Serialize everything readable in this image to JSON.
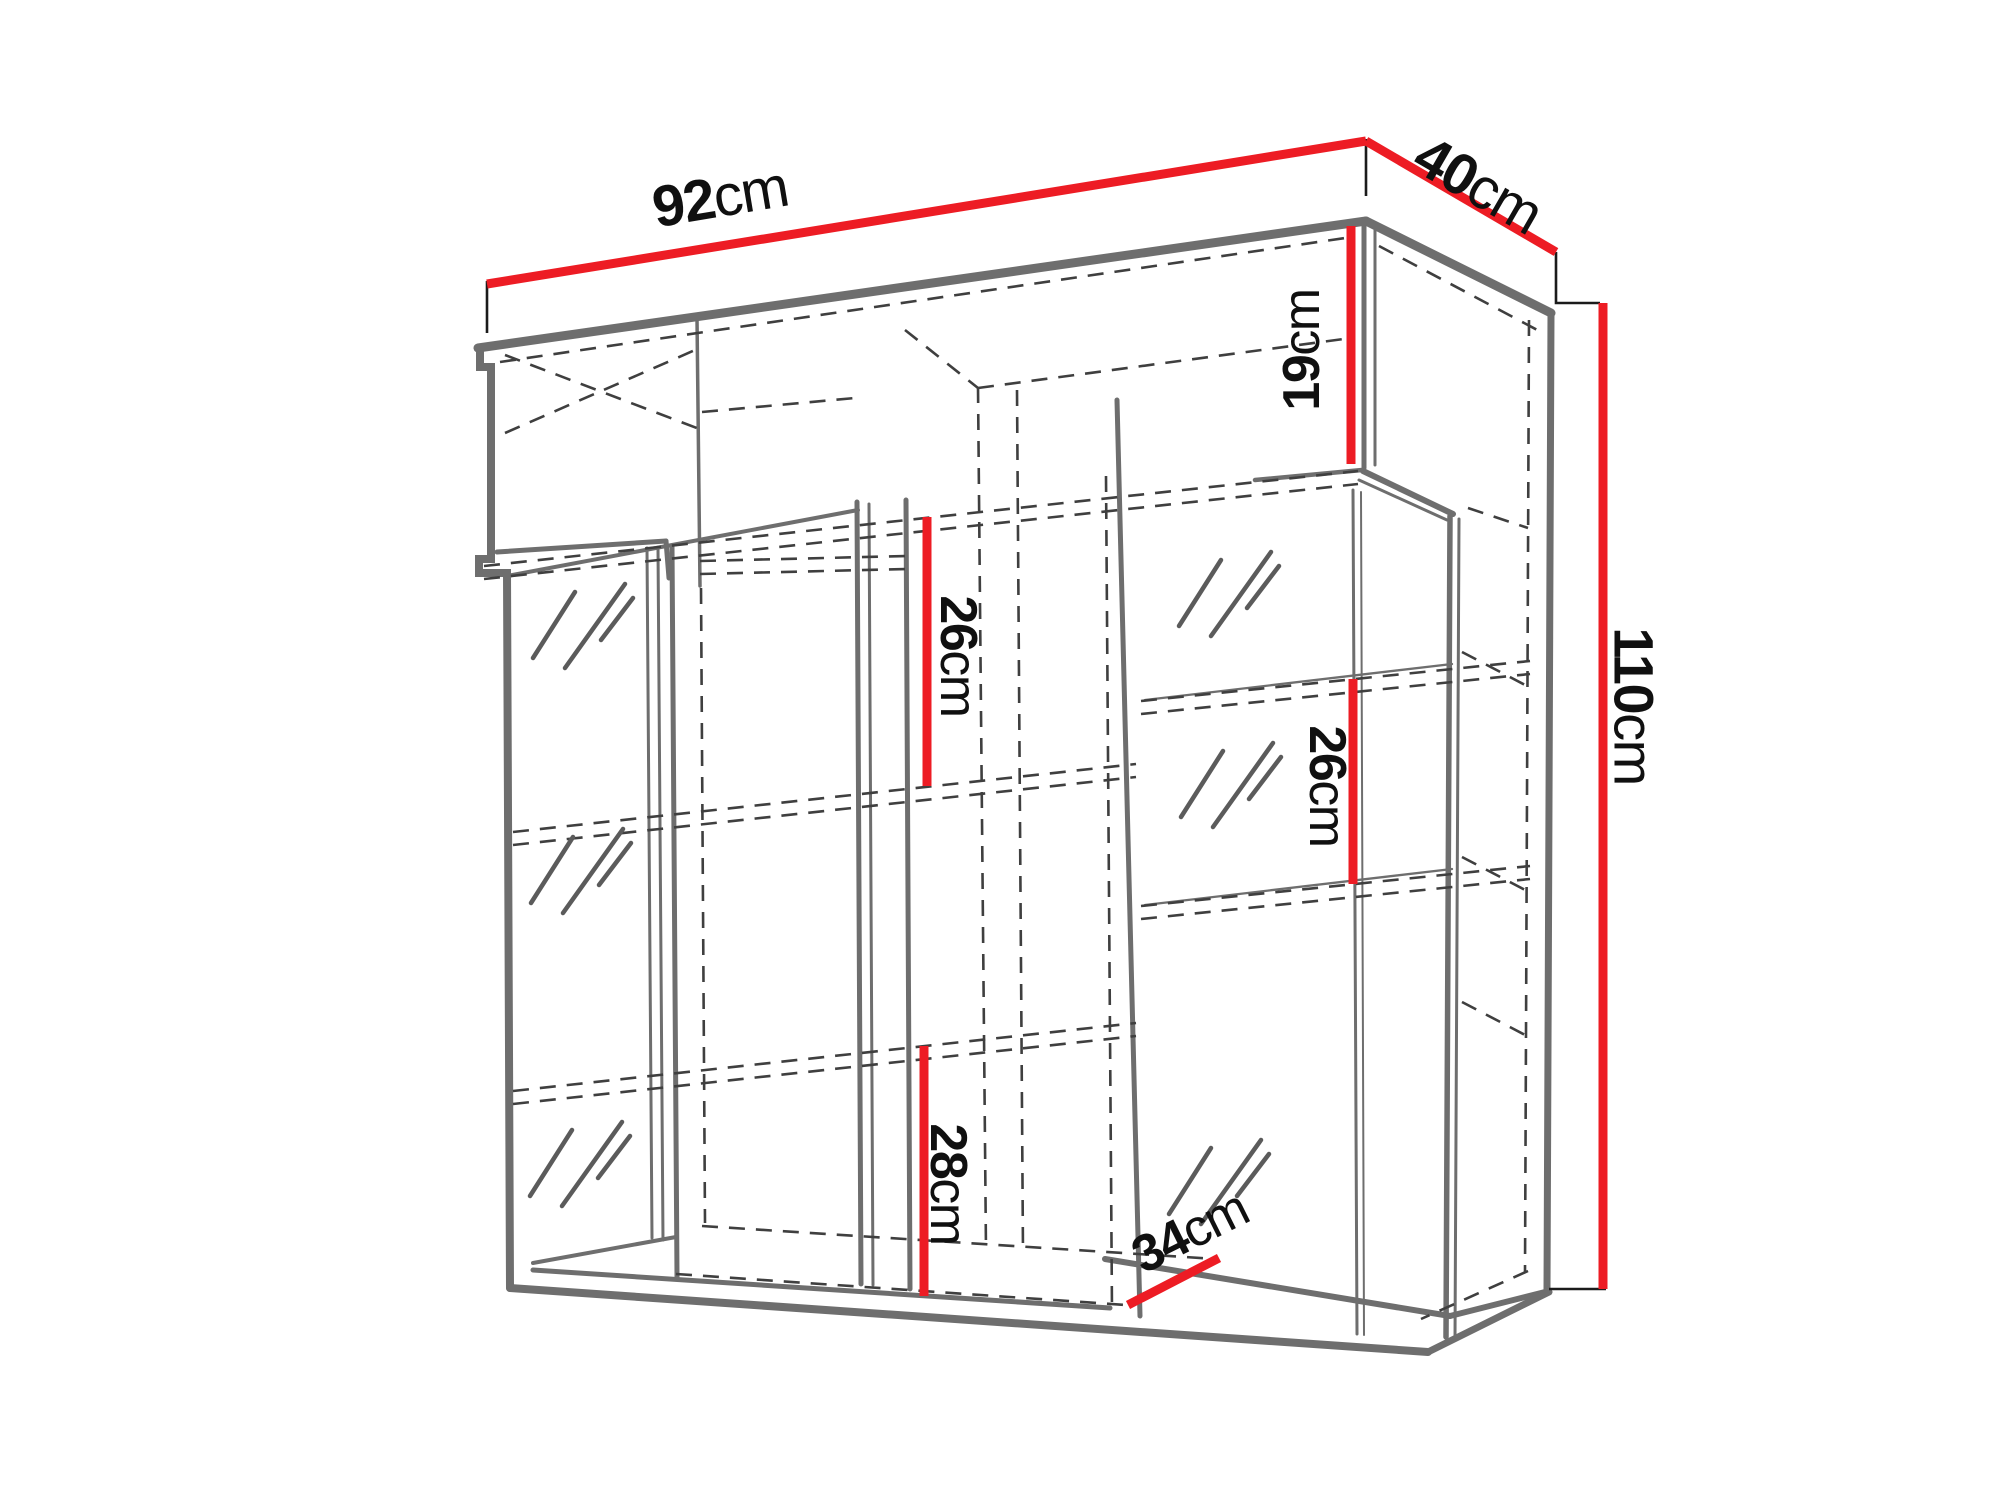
{
  "figure": {
    "type": "furniture-dimension-diagram",
    "subject": "wall-hung display cabinet with glass doors, three shelves and top compartment"
  },
  "colors": {
    "dimension_red": "#ed1c24",
    "outline_gray": "#6e6e6e",
    "dash_gray": "#3f3f3f",
    "background": "#ffffff"
  },
  "dims": {
    "width": {
      "value": "92",
      "unit": "cm"
    },
    "depth": {
      "value": "40",
      "unit": "cm"
    },
    "height": {
      "value": "110",
      "unit": "cm"
    },
    "top_compartment": {
      "value": "19",
      "unit": "cm"
    },
    "shelf_gap_left": {
      "value": "26",
      "unit": "cm"
    },
    "shelf_gap_right": {
      "value": "26",
      "unit": "cm"
    },
    "bottom_compartment": {
      "value": "28",
      "unit": "cm"
    },
    "bottom_depth": {
      "value": "34",
      "unit": "cm"
    }
  }
}
